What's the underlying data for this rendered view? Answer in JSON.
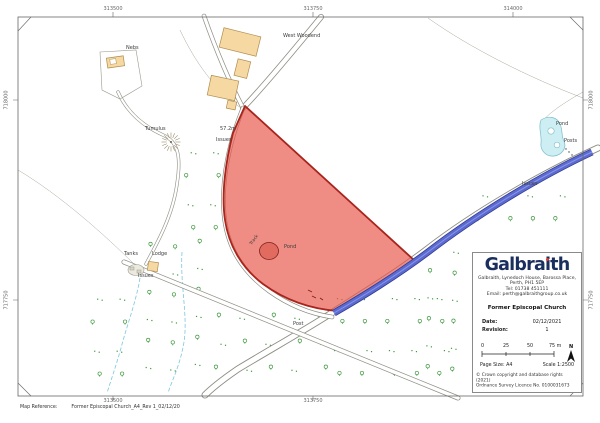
{
  "grid": {
    "top": [
      {
        "text": "313500",
        "x": 113
      },
      {
        "text": "313750",
        "x": 313
      },
      {
        "text": "314000",
        "x": 513
      }
    ],
    "bottom": [
      {
        "text": "313500",
        "x": 113
      },
      {
        "text": "313750",
        "x": 313
      }
    ],
    "left": [
      {
        "text": "718000",
        "y": 100
      },
      {
        "text": "717750",
        "y": 300
      }
    ],
    "right": [
      {
        "text": "718000",
        "y": 100
      },
      {
        "text": "717750",
        "y": 300
      }
    ]
  },
  "map_labels": [
    {
      "text": "Nebs",
      "x": 126,
      "y": 46
    },
    {
      "text": "West Woodend",
      "x": 283,
      "y": 34
    },
    {
      "text": "Tumulus",
      "x": 145,
      "y": 127
    },
    {
      "text": "57.2m",
      "x": 220,
      "y": 127
    },
    {
      "text": "Issues",
      "x": 216,
      "y": 138
    },
    {
      "text": "Pond",
      "x": 284,
      "y": 245
    },
    {
      "text": "Track",
      "x": 250,
      "y": 244,
      "rot": -55,
      "size": 4.4
    },
    {
      "text": "Tanks",
      "x": 124,
      "y": 252
    },
    {
      "text": "Lodge",
      "x": 152,
      "y": 252
    },
    {
      "text": "Issues",
      "x": 138,
      "y": 274
    },
    {
      "text": "Post",
      "x": 293,
      "y": 322
    },
    {
      "text": "Issues",
      "x": 522,
      "y": 182
    },
    {
      "text": "Pond",
      "x": 556,
      "y": 122
    },
    {
      "text": "Posts",
      "x": 564,
      "y": 139
    }
  ],
  "panel": {
    "logo_part1": "Galbra",
    "logo_part2": "i",
    "logo_part3": "th",
    "address_line1": "Galbraith, Lynedoch House, Barossa Place,",
    "address_line2": "Perth, PH1 5EP",
    "address_line3": "Tel: 01738 451111",
    "address_line4": "Email: perth@galbraithgroup.co.uk",
    "title": "Former Episcopal Church",
    "date_label": "Date:",
    "date_value": "02/12/2021",
    "revision_label": "Revision:",
    "revision_value": "1",
    "scale_ticks": [
      "0",
      "25",
      "50",
      "75 m"
    ],
    "north_label": "N",
    "page_size": "Page Size: A4",
    "scale_text": "Scale 1:2500",
    "copyright_line1": "© Crown copyright and database rights (2021)",
    "copyright_line2": "Ordnance Survey Licence No. 0100031673"
  },
  "footer": {
    "label": "Map Reference:",
    "value": "Former Episcopal Church_A4_Rev 1_02/12/20"
  },
  "colors": {
    "site_fill": "#e8574a",
    "site_border": "#a8241c",
    "road_blue": "#4d5cc7",
    "pond": "#cdeef3",
    "building": "#f6d9a2",
    "tree": "#3f9a3f",
    "stream": "#7cc8dd"
  }
}
